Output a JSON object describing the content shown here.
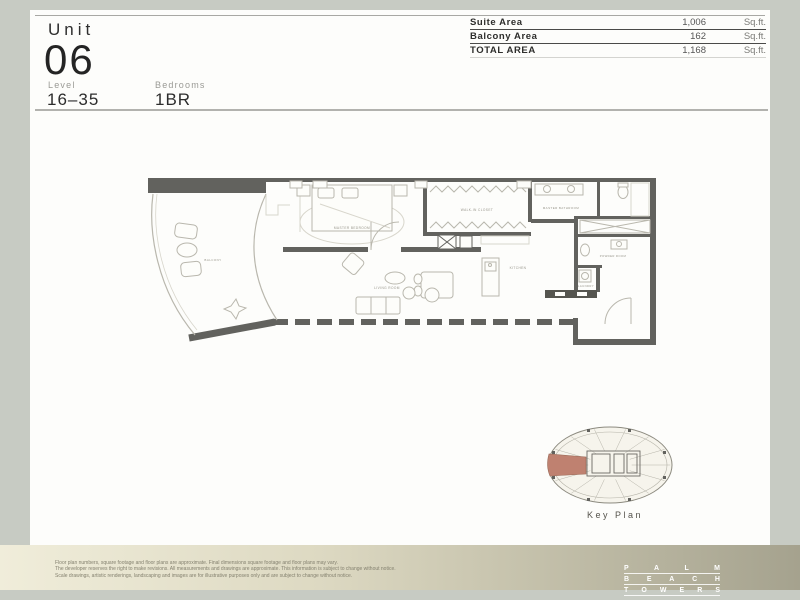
{
  "header": {
    "unit_label": "Unit",
    "unit_number": "06",
    "level_label": "Level",
    "level_value": "16–35",
    "bedrooms_label": "Bedrooms",
    "bedrooms_value": "1BR"
  },
  "area_table": {
    "rows": [
      {
        "label": "Suite Area",
        "value": "1,006",
        "unit": "Sq.ft."
      },
      {
        "label": "Balcony Area",
        "value": "162",
        "unit": "Sq.ft."
      },
      {
        "label": "TOTAL AREA",
        "value": "1,168",
        "unit": "Sq.ft."
      }
    ]
  },
  "floor_plan": {
    "labels": {
      "master_bedroom": "MASTER BEDROOM",
      "walk_in_closet": "WALK-IN CLOSET",
      "master_bathroom": "MASTER BATHROOM",
      "balcony": "BALCONY",
      "living_room": "LIVING ROOM",
      "kitchen": "KITCHEN",
      "powder_room": "POWDER ROOM",
      "laundry": "LAUNDRY"
    }
  },
  "key_plan": {
    "label": "Key Plan",
    "highlight_color": "#bf8170"
  },
  "footer": {
    "disclaimer_lines": [
      "Floor plan numbers, square footage and floor plans are approximate. Final dimensions square footage and floor plans may vary.",
      "The developer reserves the right to make revisions. All measurements and drawings are approximate. This information is subject to change without notice.",
      "Scale drawings, artistic renderings, landscaping and images are for illustrative purposes only and are subject to change without notice."
    ],
    "logo_lines": [
      "PALM",
      "BEACH",
      "TOWERS"
    ]
  },
  "colors": {
    "page_border": "#c7cbc3",
    "wall": "#62625e",
    "highlight_unit": "#bf8170",
    "band_gradient_start": "#f0edda",
    "band_gradient_end": "#a5a28e"
  }
}
